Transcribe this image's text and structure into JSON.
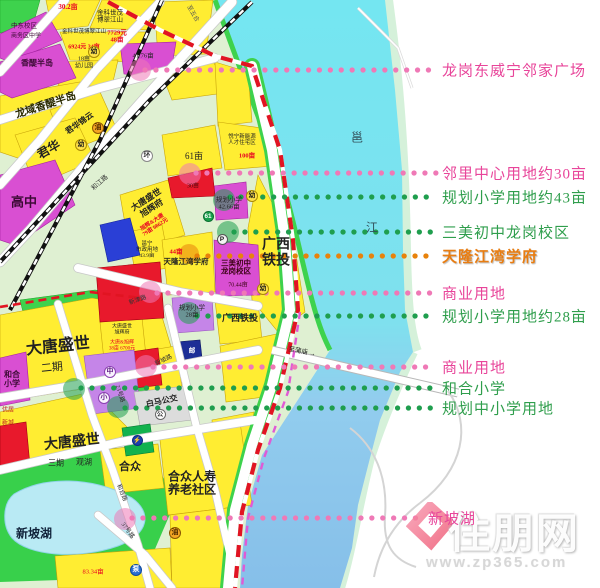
{
  "palette": {
    "pink": {
      "dot": "#ef79b6",
      "text": "#e8459a"
    },
    "green": {
      "dot": "#1f9e4e",
      "text": "#2f9e4c"
    },
    "orange": {
      "dot": "#e8820b",
      "text": "#e87d12"
    },
    "boundary_red": "#e11422",
    "metro_magenta": "#e05ad5",
    "river_cyan": "#74e6f1",
    "river_blue": "#86bfe9"
  },
  "annotations": [
    {
      "label": "龙岗东威宁邻家广场",
      "color": "pink",
      "y": 70,
      "x1": 145,
      "x2": 436,
      "xt": 442,
      "ax": 140,
      "ay": 70
    },
    {
      "label": "邻里中心用地约30亩",
      "color": "pink",
      "y": 173,
      "x1": 196,
      "x2": 436,
      "xt": 442,
      "ax": 190,
      "ay": 174
    },
    {
      "label": "规划小学用地约43亩",
      "color": "green",
      "y": 197,
      "x1": 230,
      "x2": 436,
      "xt": 442,
      "ax": 224,
      "ay": 200
    },
    {
      "label": "三美初中龙岗校区",
      "color": "green",
      "y": 232,
      "x1": 234,
      "x2": 436,
      "xt": 442,
      "ax": 228,
      "ay": 232
    },
    {
      "label": "天隆江湾学府",
      "color": "orange",
      "y": 256,
      "x1": 197,
      "x2": 436,
      "xt": 442,
      "ax": 189,
      "ay": 254
    },
    {
      "label": "商业用地",
      "color": "pink",
      "y": 293,
      "x1": 157,
      "x2": 436,
      "xt": 442,
      "ax": 150,
      "ay": 292
    },
    {
      "label": "规划小学用地约28亩",
      "color": "green",
      "y": 316,
      "x1": 197,
      "x2": 436,
      "xt": 442,
      "ax": 189,
      "ay": 313
    },
    {
      "label": "商业用地",
      "color": "pink",
      "y": 367,
      "x1": 153,
      "x2": 436,
      "xt": 442,
      "ax": 146,
      "ay": 366
    },
    {
      "label": "和合小学",
      "color": "green",
      "y": 388,
      "x1": 81,
      "x2": 436,
      "xt": 442,
      "ax": 74,
      "ay": 389
    },
    {
      "label": "规划中小学用地",
      "color": "green",
      "y": 408,
      "x1": 125,
      "x2": 436,
      "xt": 442,
      "ax": 118,
      "ay": 407
    },
    {
      "label": "新坡湖",
      "color": "pink",
      "y": 518,
      "x1": 132,
      "x2": 424,
      "xt": 428,
      "ax": 125,
      "ay": 519
    }
  ],
  "map": {
    "labels": [
      {
        "t": "30.2亩",
        "x": 68,
        "y": 8,
        "fs": 7,
        "c": "#e80020",
        "b": 1
      },
      {
        "t": "金科世茂\n博翠江山",
        "x": 110,
        "y": 17,
        "fs": 6.5,
        "c": "#222222"
      },
      {
        "t": "7729元\n48亩",
        "x": 117,
        "y": 37,
        "fs": 6.5,
        "c": "#e80020",
        "b": 1
      },
      {
        "t": "金科世茂博翠江山",
        "x": 84,
        "y": 32,
        "fs": 5.5,
        "c": "#222222"
      },
      {
        "t": "6924元 34亩",
        "x": 84,
        "y": 48,
        "fs": 6,
        "c": "#e80020",
        "b": 1
      },
      {
        "t": "18亩\n幼儿园",
        "x": 84,
        "y": 63,
        "fs": 6,
        "c": "#222222"
      },
      {
        "t": "41.76亩",
        "x": 143,
        "y": 56,
        "fs": 6.5,
        "c": "#222222"
      },
      {
        "t": "中东校区",
        "x": 24,
        "y": 26,
        "fs": 6.5,
        "c": "#3c0a35"
      },
      {
        "t": "商务区中学",
        "x": 26,
        "y": 37,
        "fs": 6,
        "c": "#3c0a35"
      },
      {
        "t": "香醍半岛",
        "x": 37,
        "y": 64,
        "fs": 8,
        "c": "#3c0a35",
        "b": 1
      },
      {
        "t": "龙域香醍半岛",
        "x": 46,
        "y": 106,
        "fs": 10.5,
        "c": "#2a2a00",
        "b": 1,
        "r": -18
      },
      {
        "t": "君华锦云",
        "x": 80,
        "y": 124,
        "fs": 8,
        "c": "#222222",
        "b": 1,
        "r": -35
      },
      {
        "t": "君华",
        "x": 49,
        "y": 150,
        "fs": 12,
        "c": "#222222",
        "b": 1,
        "r": -30
      },
      {
        "t": "高中",
        "x": 24,
        "y": 203,
        "fs": 13,
        "c": "#3c0a35",
        "b": 1
      },
      {
        "t": "61亩",
        "x": 194,
        "y": 156,
        "fs": 9,
        "c": "#222222"
      },
      {
        "t": "悦宁新能源\n人才住宅区",
        "x": 242,
        "y": 140,
        "fs": 5.5,
        "c": "#222222"
      },
      {
        "t": "100亩",
        "x": 247,
        "y": 156,
        "fs": 6.5,
        "c": "#e80020",
        "b": 1
      },
      {
        "t": "30亩",
        "x": 193,
        "y": 187,
        "fs": 6,
        "c": "#40060b"
      },
      {
        "t": "大唐盛世\n旭辉府",
        "x": 149,
        "y": 204,
        "fs": 8.5,
        "c": "#222222",
        "b": 1,
        "r": -33
      },
      {
        "t": "旭辉&大唐\n79亩 6862元",
        "x": 154,
        "y": 225,
        "fs": 5.5,
        "c": "#e80020",
        "b": 1,
        "r": -33
      },
      {
        "t": "规划小学\n42.66亩",
        "x": 229,
        "y": 204,
        "fs": 6.5,
        "c": "#222222"
      },
      {
        "t": "广西\n铁投",
        "x": 276,
        "y": 253,
        "fs": 14,
        "c": "#222222",
        "b": 1
      },
      {
        "t": "邕宁\n市政用地\n43.9亩",
        "x": 147,
        "y": 250,
        "fs": 5.5,
        "c": "#222222"
      },
      {
        "t": "44亩",
        "x": 176,
        "y": 252,
        "fs": 6.5,
        "c": "#e80020",
        "b": 1
      },
      {
        "t": "天隆江湾学府",
        "x": 186,
        "y": 262,
        "fs": 7.5,
        "c": "#222222",
        "b": 1
      },
      {
        "t": "三美初中\n龙岗校区",
        "x": 236,
        "y": 268,
        "fs": 7.5,
        "c": "#3a0112",
        "b": 1
      },
      {
        "t": "70.44亩",
        "x": 238,
        "y": 286,
        "fs": 6,
        "c": "#3a0112"
      },
      {
        "t": "广西铁投",
        "x": 240,
        "y": 318,
        "fs": 9,
        "c": "#222222",
        "b": 1
      },
      {
        "t": "规划小学\n28亩",
        "x": 192,
        "y": 312,
        "fs": 6.5,
        "c": "#222222"
      },
      {
        "t": "大唐盛世",
        "x": 58,
        "y": 347,
        "fs": 16,
        "c": "#222222",
        "b": 1,
        "r": -6
      },
      {
        "t": "二期",
        "x": 52,
        "y": 368,
        "fs": 11,
        "c": "#222222",
        "r": -6
      },
      {
        "t": "和合\n小学",
        "x": 12,
        "y": 380,
        "fs": 8,
        "c": "#3c0a35",
        "b": 1
      },
      {
        "t": "大唐盛世\n旭辉府",
        "x": 122,
        "y": 330,
        "fs": 5,
        "c": "#222222"
      },
      {
        "t": "大唐&旭辉\n38亩 6700元",
        "x": 122,
        "y": 346,
        "fs": 5,
        "c": "#e80020"
      },
      {
        "t": "白马公交",
        "x": 162,
        "y": 402,
        "fs": 8,
        "c": "#222222",
        "b": 1,
        "r": -12
      },
      {
        "t": "优居",
        "x": 8,
        "y": 411,
        "fs": 6,
        "c": "#c02020"
      },
      {
        "t": "新城",
        "x": 8,
        "y": 424,
        "fs": 6,
        "c": "#c02020"
      },
      {
        "t": "大唐盛世",
        "x": 72,
        "y": 443,
        "fs": 14,
        "c": "#222222",
        "b": 1,
        "r": -6
      },
      {
        "t": "三期",
        "x": 56,
        "y": 464,
        "fs": 8,
        "c": "#222222"
      },
      {
        "t": "观湖",
        "x": 84,
        "y": 463,
        "fs": 8,
        "c": "#222222"
      },
      {
        "t": "合众",
        "x": 130,
        "y": 467,
        "fs": 11,
        "c": "#222222",
        "b": 1
      },
      {
        "t": "合众人寿\n养老社区",
        "x": 192,
        "y": 484,
        "fs": 12,
        "c": "#222222",
        "b": 1
      },
      {
        "t": "新坡湖",
        "x": 34,
        "y": 534,
        "fs": 12,
        "c": "#10223a",
        "b": 1
      },
      {
        "t": "83.34亩",
        "x": 93,
        "y": 572,
        "fs": 6.5,
        "c": "#e80020"
      },
      {
        "t": "邕",
        "x": 357,
        "y": 138,
        "fs": 12,
        "c": "#33505a"
      },
      {
        "t": "江",
        "x": 372,
        "y": 228,
        "fs": 12,
        "c": "#33505a"
      },
      {
        "t": "邮",
        "x": 192,
        "y": 351,
        "fs": 6.5,
        "c": "#ffffff",
        "b": 1
      },
      {
        "t": "和江路",
        "x": 100,
        "y": 183,
        "fs": 6.5,
        "c": "#333333",
        "r": -42
      },
      {
        "t": "新津路",
        "x": 138,
        "y": 301,
        "fs": 6,
        "c": "#333333",
        "r": -20
      },
      {
        "t": "新坡路",
        "x": 164,
        "y": 361,
        "fs": 6,
        "c": "#333333",
        "r": -26
      },
      {
        "t": "23号路",
        "x": 119,
        "y": 394,
        "fs": 6,
        "c": "#333333",
        "r": 72
      },
      {
        "t": "和合路",
        "x": 121,
        "y": 493,
        "fs": 6,
        "c": "#333333",
        "r": 68
      },
      {
        "t": "37号路",
        "x": 127,
        "y": 531,
        "fs": 6,
        "c": "#333333",
        "r": 55
      },
      {
        "t": "至蒲庙 →",
        "x": 302,
        "y": 352,
        "fs": 6.5,
        "c": "#222222",
        "r": 11
      },
      {
        "t": "至五合",
        "x": 192,
        "y": 14,
        "fs": 6,
        "c": "#555555",
        "r": 60
      }
    ],
    "icons": [
      {
        "g": "幼",
        "x": 94,
        "y": 52,
        "r": 6,
        "bg": "#ffe24a",
        "fg": "#1a1a1a",
        "bc": "#a98a00"
      },
      {
        "g": "幼",
        "x": 81,
        "y": 145,
        "r": 6,
        "bg": "#ffe24a",
        "fg": "#1a1a1a",
        "bc": "#a98a00"
      },
      {
        "g": "幼",
        "x": 252,
        "y": 196,
        "r": 6,
        "bg": "#ffe24a",
        "fg": "#1a1a1a",
        "bc": "#a98a00"
      },
      {
        "g": "幼",
        "x": 263,
        "y": 289,
        "r": 6,
        "bg": "#ffe24a",
        "fg": "#1a1a1a",
        "bc": "#a98a00"
      },
      {
        "g": "油",
        "x": 98,
        "y": 128,
        "r": 6,
        "bg": "#f5a623",
        "fg": "#4a2800",
        "bc": "#8a5500"
      },
      {
        "g": "油",
        "x": 175,
        "y": 533,
        "r": 6,
        "bg": "#f5a623",
        "fg": "#4a2800",
        "bc": "#8a5500"
      },
      {
        "g": "环",
        "x": 147,
        "y": 156,
        "r": 6,
        "bg": "#ffffff",
        "fg": "#333333",
        "bc": "#888888"
      },
      {
        "g": "P",
        "x": 222,
        "y": 239,
        "r": 5.5,
        "bg": "#f2f2f2",
        "fg": "#111111",
        "bc": "#555555"
      },
      {
        "g": "61",
        "x": 208,
        "y": 216,
        "r": 5.5,
        "bg": "#18a04a",
        "fg": "#ffffff",
        "bc": "#0a6e30"
      },
      {
        "g": "中",
        "x": 110,
        "y": 372,
        "r": 6,
        "bg": "#faf4ff",
        "fg": "#5a1580",
        "bc": "#8a40b0"
      },
      {
        "g": "小",
        "x": 104,
        "y": 398,
        "r": 6,
        "bg": "#faf4ff",
        "fg": "#5a1580",
        "bc": "#8a40b0"
      },
      {
        "g": "公",
        "x": 160,
        "y": 414,
        "r": 5.5,
        "bg": "#ffffff",
        "fg": "#333333",
        "bc": "#666666"
      },
      {
        "g": "⚡",
        "x": 137,
        "y": 440,
        "r": 5.5,
        "bg": "#1b3fae",
        "fg": "#ffe000",
        "bc": "#0c2a80"
      },
      {
        "g": "泵",
        "x": 136,
        "y": 570,
        "r": 6,
        "bg": "#2a6fd0",
        "fg": "#ffffff",
        "bc": "#114a9e"
      }
    ]
  },
  "watermark": {
    "brand": "住朋网",
    "url": "www.zp365.com"
  }
}
